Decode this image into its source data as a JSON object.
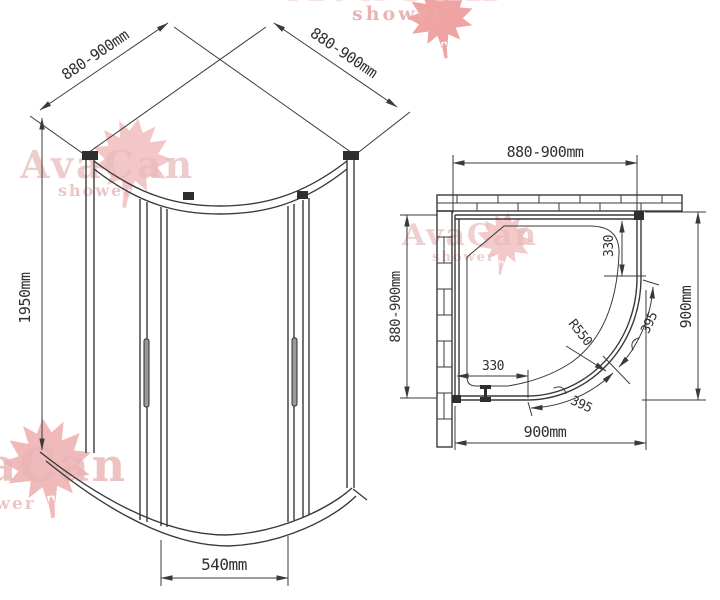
{
  "brand": {
    "name": "AvaCan",
    "tagline": "shower"
  },
  "colors": {
    "line": "#3a3a3a",
    "dim_text": "#2f2f2f",
    "watermark_text": "#e9bcbc",
    "watermark_leaf": "#eda4a4"
  },
  "front_view": {
    "dim_top_left": "880-900mm",
    "dim_top_right": "880-900mm",
    "dim_height": "1950mm",
    "dim_door_width": "540mm"
  },
  "plan_view": {
    "dim_top": "880-900mm",
    "dim_left": "880-900mm",
    "dim_right": "900mm",
    "dim_bottom": "900mm",
    "dim_fixed_panel_right": "330",
    "dim_fixed_panel_bottom": "330",
    "dim_radius": "R550",
    "dim_door_arc_right": "395",
    "dim_door_arc_bottom": "395"
  }
}
